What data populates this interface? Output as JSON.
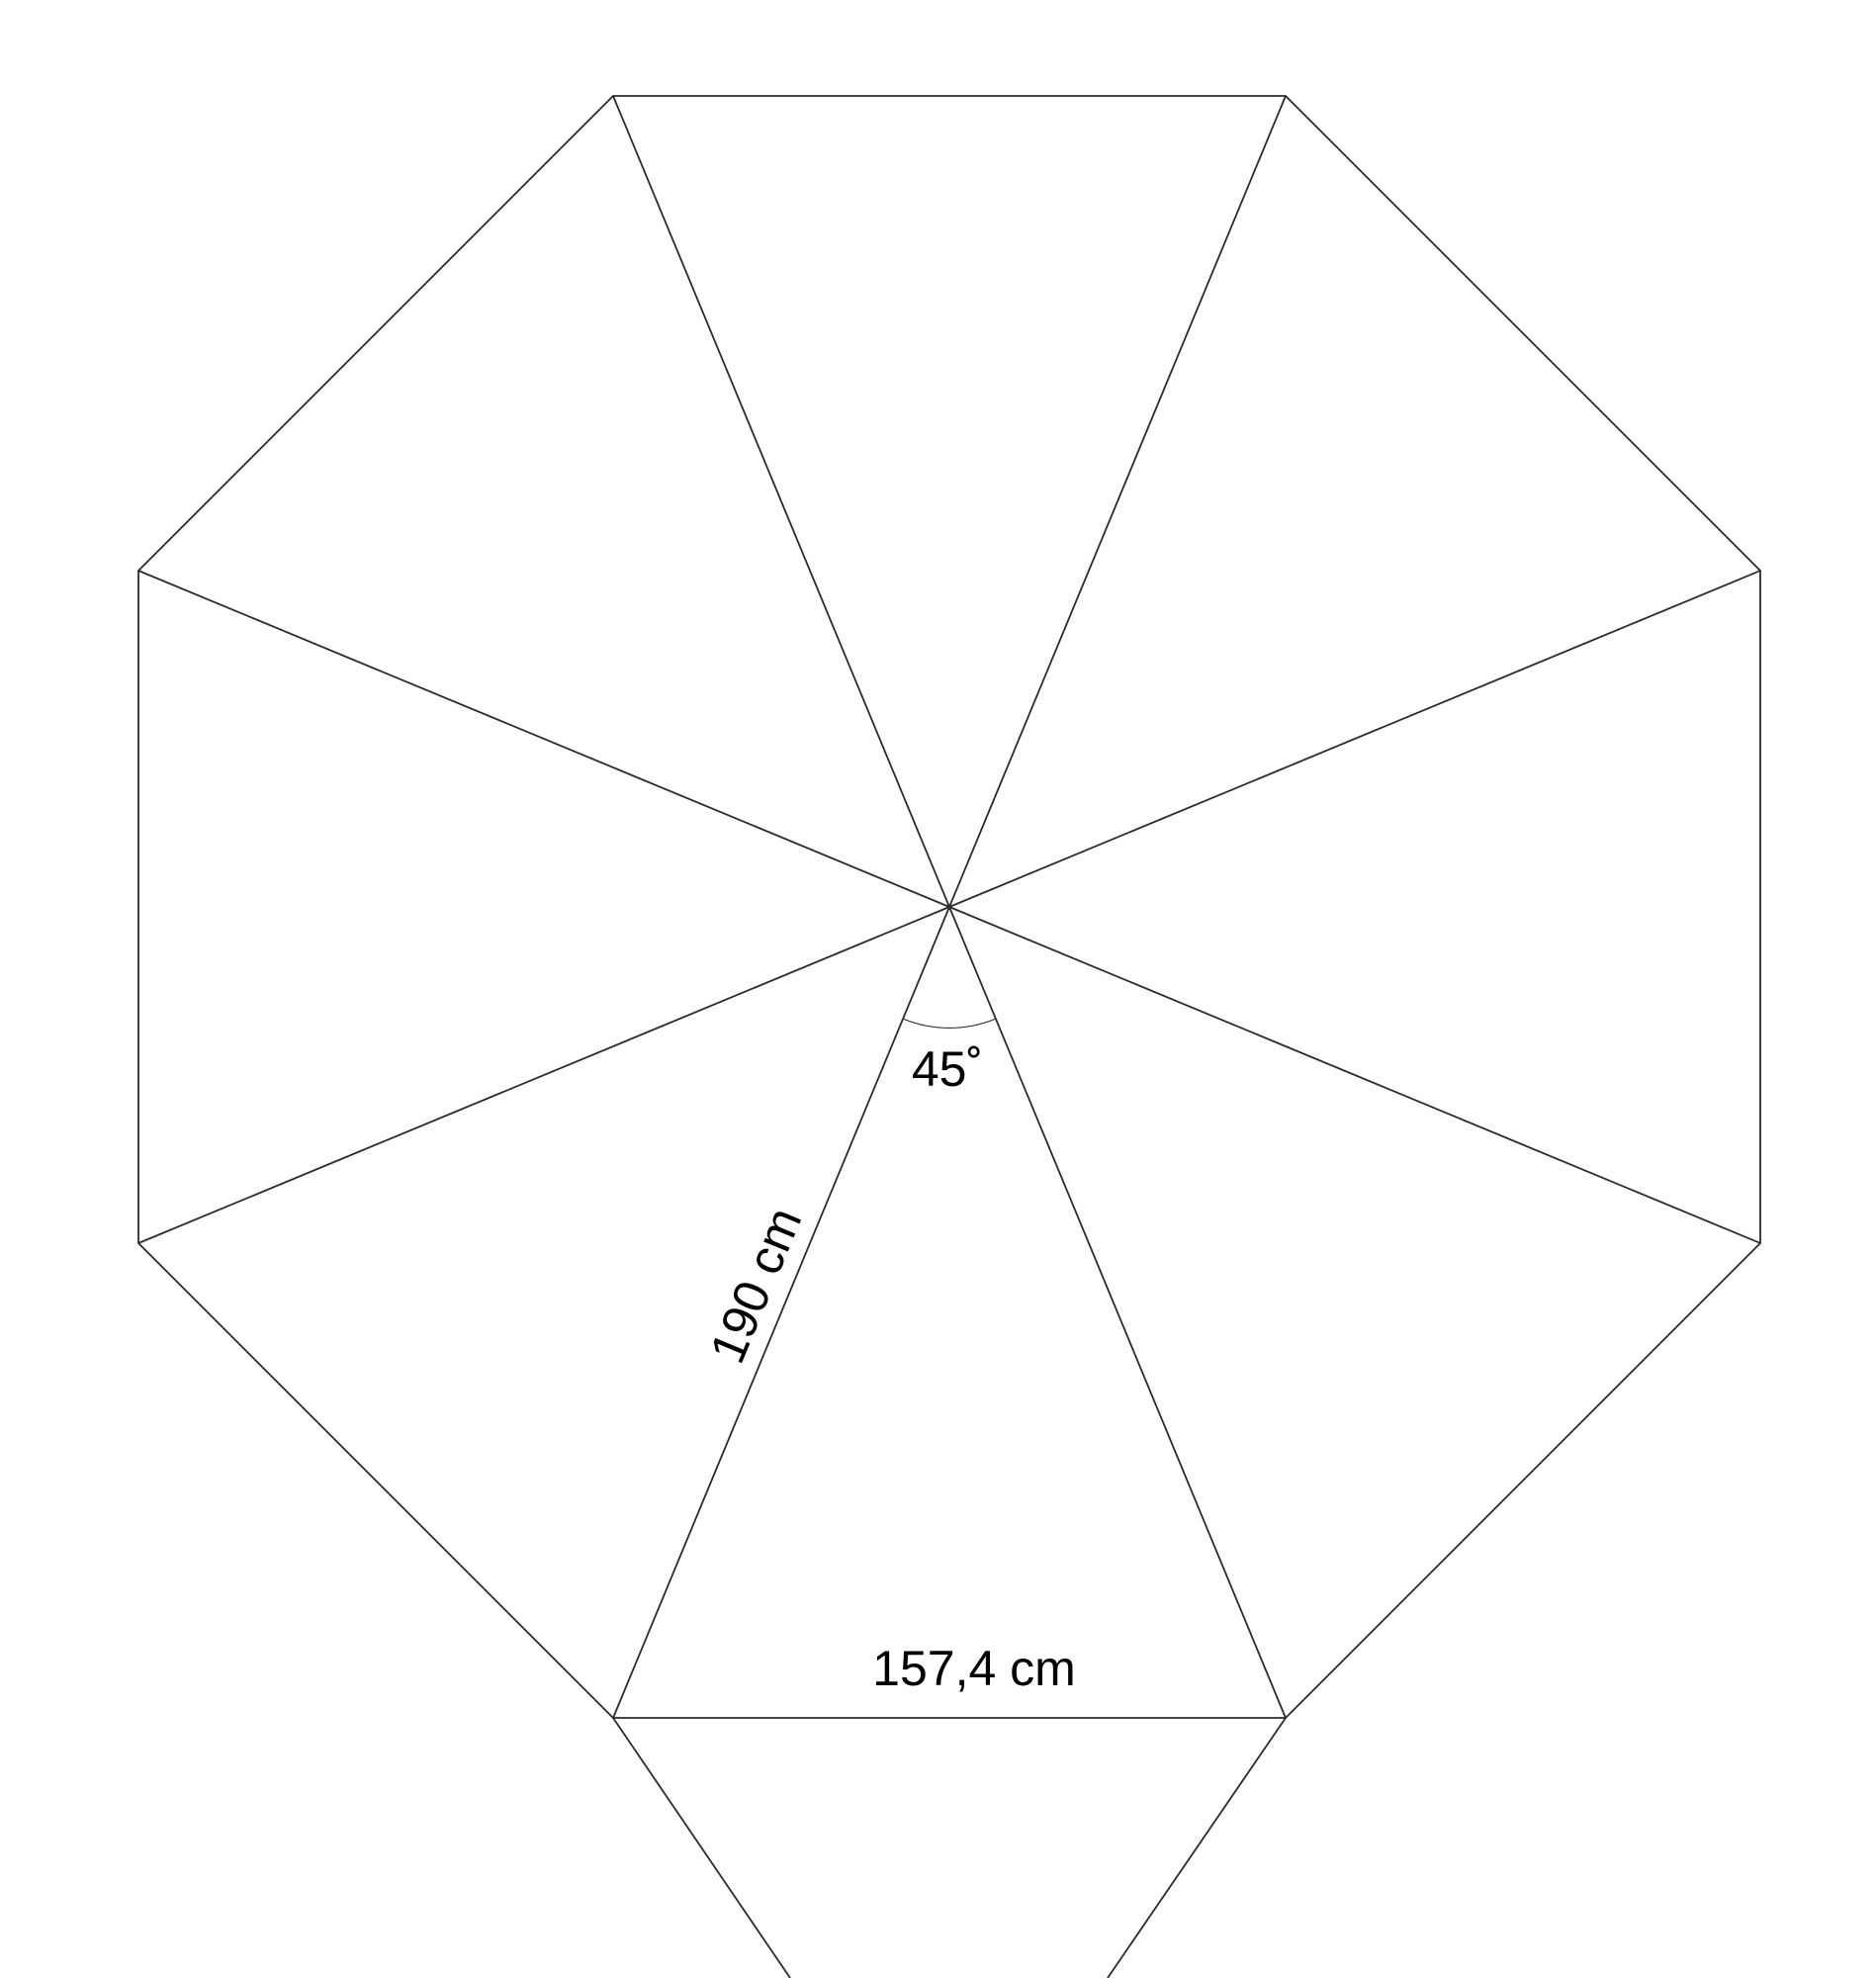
{
  "figure": {
    "description": "Cutting pattern diagram: regular octagon divided into 8 congruent isosceles triangular gores radiating from the center, with two flap lines extending below the bottom edge",
    "gore_count": 8,
    "labels": {
      "apex_angle": "45˚",
      "gore_side_length": "190 cm",
      "gore_base_length": "157,4 cm"
    },
    "values": {
      "apex_angle_deg": 45,
      "gore_side_cm": 190,
      "gore_base_cm": 157.4
    },
    "colors": {
      "line": "#2b2b2b",
      "arc": "#2b2b2b",
      "text": "#000000",
      "background": "#ffffff"
    }
  }
}
